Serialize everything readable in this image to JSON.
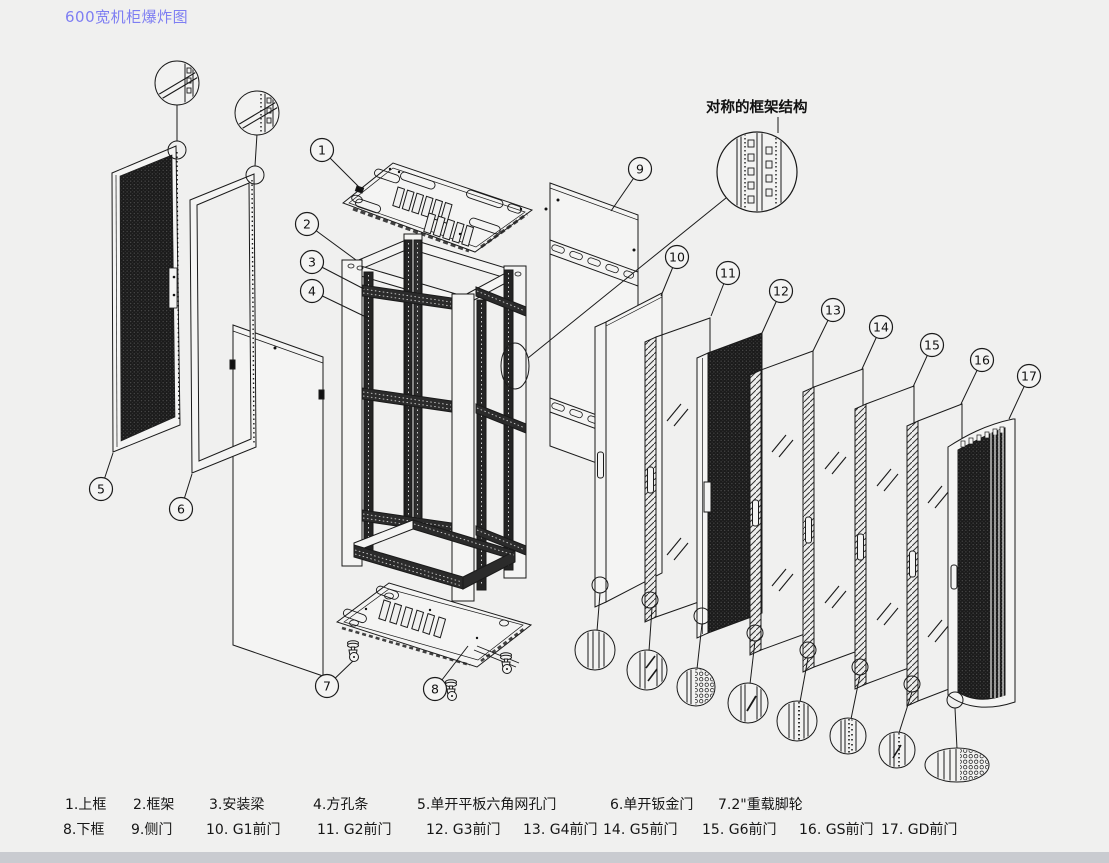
{
  "title": "600宽机柜爆炸图",
  "annotation": "对称的框架结构",
  "colors": {
    "title_text": "#7e7ef2",
    "line": "#1a1a1a",
    "background": "#f0f0ef",
    "mesh_fill": "#1b1b1b",
    "bottom_band": "#c9cbd0"
  },
  "legend": {
    "row1": [
      {
        "num": "1",
        "label": "1.上框"
      },
      {
        "num": "2",
        "label": "2.框架"
      },
      {
        "num": "3",
        "label": "3.安装梁"
      },
      {
        "num": "4",
        "label": "4.方孔条"
      },
      {
        "num": "5",
        "label": "5.单开平板六角网孔门"
      },
      {
        "num": "6",
        "label": "6.单开钣金门"
      },
      {
        "num": "7",
        "label": "7.2\"重载脚轮"
      }
    ],
    "row2": [
      {
        "num": "8",
        "label": "8.下框"
      },
      {
        "num": "9",
        "label": "9.侧门"
      },
      {
        "num": "10",
        "label": "10. G1前门"
      },
      {
        "num": "11",
        "label": "11. G2前门"
      },
      {
        "num": "12",
        "label": "12. G3前门"
      },
      {
        "num": "13",
        "label": "13. G4前门"
      },
      {
        "num": "14",
        "label": "14. G5前门"
      },
      {
        "num": "15",
        "label": "15. G6前门"
      },
      {
        "num": "16",
        "label": "16. GS前门"
      },
      {
        "num": "17",
        "label": "17. GD前门"
      }
    ]
  },
  "callouts": [
    {
      "num": "1",
      "cx": 322,
      "cy": 150,
      "tx": 362,
      "ty": 190
    },
    {
      "num": "2",
      "cx": 307,
      "cy": 224,
      "tx": 356,
      "ty": 260
    },
    {
      "num": "3",
      "cx": 312,
      "cy": 262,
      "tx": 364,
      "ty": 289
    },
    {
      "num": "4",
      "cx": 312,
      "cy": 291,
      "tx": 368,
      "ty": 318
    },
    {
      "num": "5",
      "cx": 101,
      "cy": 489,
      "tx": 113,
      "ty": 453
    },
    {
      "num": "6",
      "cx": 181,
      "cy": 509,
      "tx": 192,
      "ty": 474
    },
    {
      "num": "7",
      "cx": 327,
      "cy": 686,
      "tx": 353,
      "ty": 661
    },
    {
      "num": "8",
      "cx": 435,
      "cy": 689,
      "tx": 468,
      "ty": 646
    },
    {
      "num": "9",
      "cx": 640,
      "cy": 169,
      "tx": 611,
      "ty": 211
    },
    {
      "num": "10",
      "cx": 677,
      "cy": 257,
      "tx": 661,
      "ty": 296
    },
    {
      "num": "11",
      "cx": 728,
      "cy": 273,
      "tx": 711,
      "ty": 316
    },
    {
      "num": "12",
      "cx": 781,
      "cy": 291,
      "tx": 762,
      "ty": 333
    },
    {
      "num": "13",
      "cx": 833,
      "cy": 310,
      "tx": 813,
      "ty": 351
    },
    {
      "num": "14",
      "cx": 881,
      "cy": 327,
      "tx": 862,
      "ty": 369
    },
    {
      "num": "15",
      "cx": 932,
      "cy": 345,
      "tx": 913,
      "ty": 387
    },
    {
      "num": "16",
      "cx": 982,
      "cy": 360,
      "tx": 961,
      "ty": 404
    },
    {
      "num": "17",
      "cx": 1029,
      "cy": 376,
      "tx": 1009,
      "ty": 419
    }
  ]
}
